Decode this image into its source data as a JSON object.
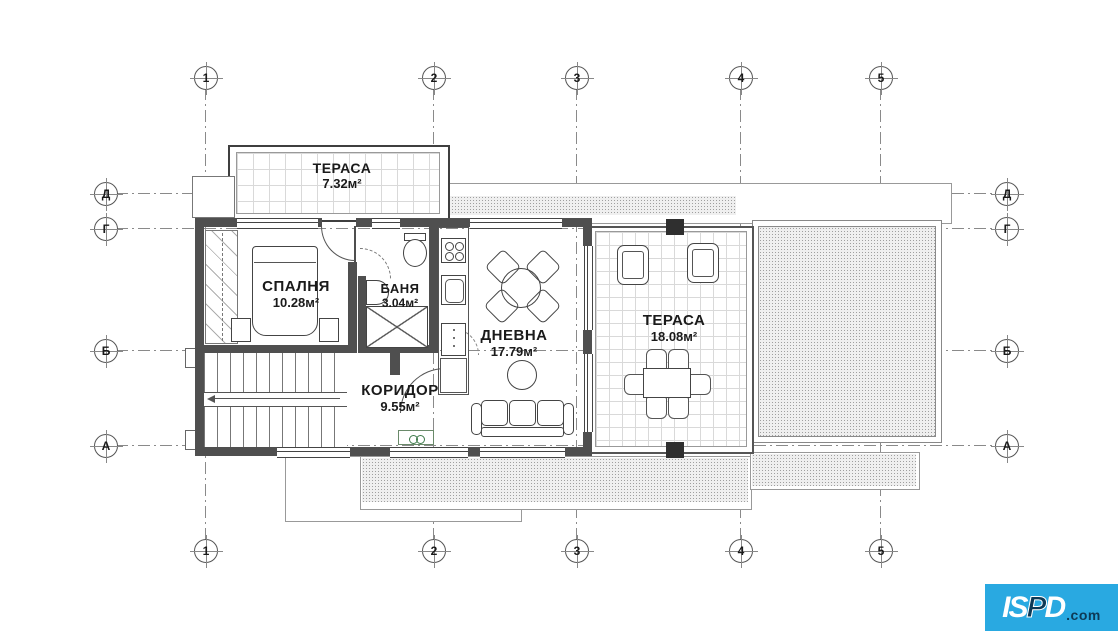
{
  "grid": {
    "columns": [
      "1",
      "2",
      "3",
      "4",
      "5"
    ],
    "rows": [
      "Д",
      "Г",
      "Б",
      "А"
    ]
  },
  "rooms": {
    "terrace_top": {
      "label": "ТЕРАСА",
      "area": "7.32м²"
    },
    "bedroom": {
      "label": "СПАЛНЯ",
      "area": "10.28м²"
    },
    "bath": {
      "label": "БАНЯ",
      "area": "3.04м²"
    },
    "living": {
      "label": "ДНЕВНА",
      "area": "17.79м²"
    },
    "corridor": {
      "label": "КОРИДОР",
      "area": "9.55м²"
    },
    "terrace_right": {
      "label": "ТЕРАСА",
      "area": "18.08м²"
    }
  },
  "logo": {
    "brand_a": "IS",
    "brand_b": "P",
    "brand_c": "D",
    "suffix": ".com"
  },
  "colors": {
    "wall": "#4f4f4f",
    "logo_bg": "#29a9e1",
    "logo_dark": "#0d3a56"
  }
}
